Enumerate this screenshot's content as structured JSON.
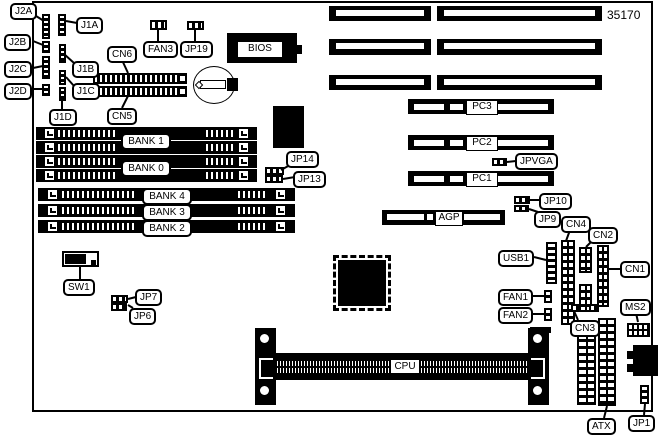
{
  "diagram": {
    "part_number": "35170",
    "kind": "motherboard-layout"
  },
  "callouts": {
    "j2a": "J2A",
    "j2b": "J2B",
    "j2c": "J2C",
    "j2d": "J2D",
    "j1a": "J1A",
    "j1b": "J1B",
    "j1c": "J1C",
    "j1d": "J1D",
    "cn6": "CN6",
    "cn5": "CN5",
    "fan3": "FAN3",
    "jp19": "JP19",
    "jp14": "JP14",
    "jp13": "JP13",
    "jpvga": "JPVGA",
    "jp10": "JP10",
    "jp9": "JP9",
    "cn4": "CN4",
    "cn2": "CN2",
    "cn1": "CN1",
    "cn3": "CN3",
    "usb1": "USB1",
    "fan1": "FAN1",
    "fan2": "FAN2",
    "ms2": "MS2",
    "atx": "ATX",
    "jp1": "JP1",
    "sw1": "SW1",
    "jp7": "JP7",
    "jp6": "JP6"
  },
  "slots": {
    "pci": [
      "PC3",
      "PC2",
      "PC1"
    ],
    "agp": "AGP",
    "cpu": "CPU",
    "bios": "BIOS",
    "banks_top": [
      "BANK 1",
      "BANK 0"
    ],
    "banks_bottom": [
      "BANK 4",
      "BANK 3",
      "BANK 2"
    ]
  }
}
